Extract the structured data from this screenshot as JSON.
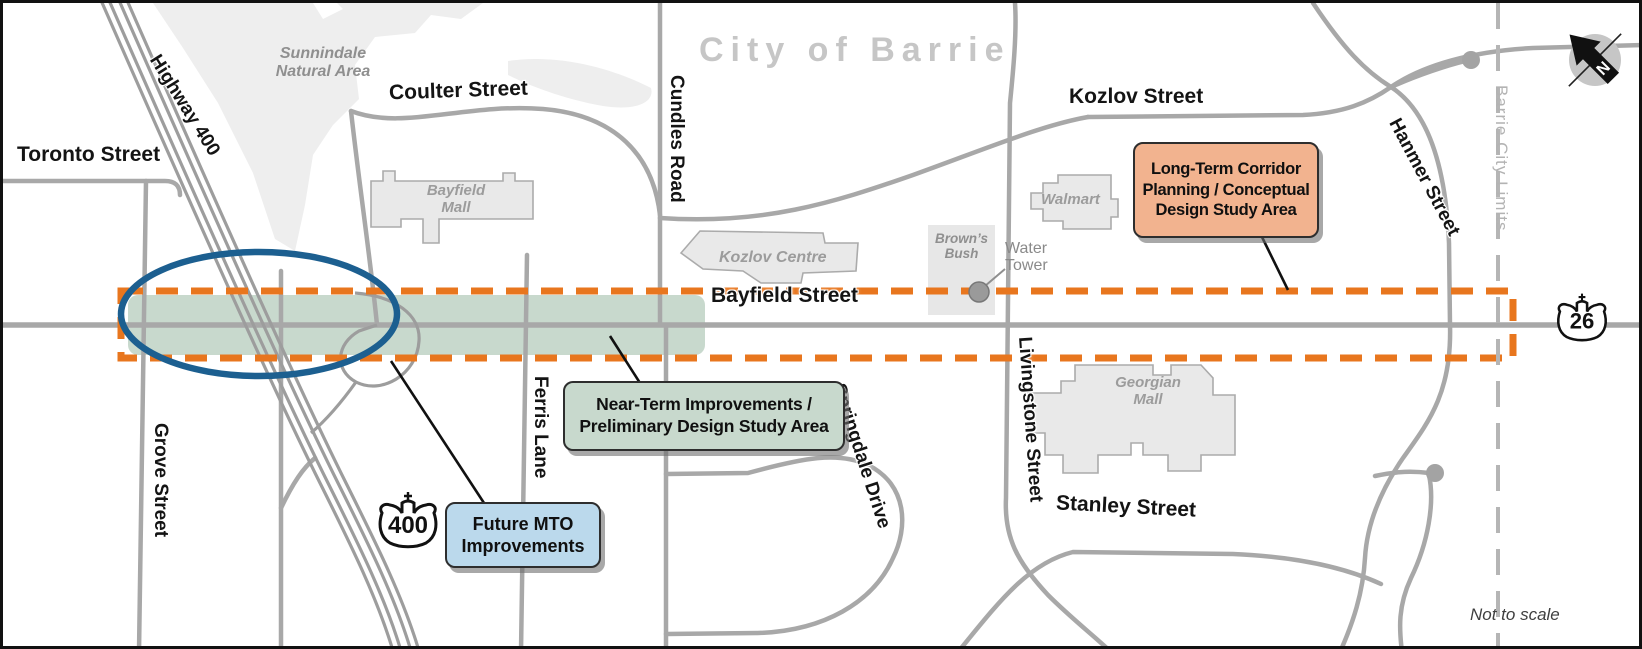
{
  "map_title": "City of Barrie",
  "scale_note": "Not to scale",
  "boundary_label": "Barrie City Limits",
  "compass": {
    "north_label": "N"
  },
  "streets": {
    "toronto": "Toronto Street",
    "coulter": "Coulter Street",
    "kozlov": "Kozlov Street",
    "bayfield": "Bayfield Street",
    "stanley": "Stanley Street",
    "grove": "Grove Street",
    "ferris": "Ferris Lane",
    "cundles": "Cundles Road",
    "livingstone": "Livingstone Street",
    "hanmer": "Hanmer Street",
    "springdale": "Springdale Drive",
    "highway400": "Highway 400"
  },
  "highway_shields": {
    "h400": "400",
    "h26": "26"
  },
  "places": {
    "sunnindale": {
      "lines": [
        "Sunnindale",
        "Natural Area"
      ]
    },
    "bayfield_mall": {
      "lines": [
        "Bayfield",
        "Mall"
      ]
    },
    "kozlov_centre": {
      "lines": [
        "Kozlov Centre"
      ]
    },
    "browns_bush": {
      "lines": [
        "Brown’s",
        "Bush"
      ]
    },
    "walmart": {
      "lines": [
        "Walmart"
      ]
    },
    "georgian_mall": {
      "lines": [
        "Georgian",
        "Mall"
      ]
    },
    "water_tower": {
      "lines": [
        "Water",
        "Tower"
      ]
    }
  },
  "callouts": {
    "long_term": {
      "lines": [
        "Long-Term Corridor",
        "Planning / Conceptual",
        "Design Study Area"
      ],
      "fill": "#F2B38F"
    },
    "near_term": {
      "lines": [
        "Near-Term Improvements /",
        "Preliminary Design Study Area"
      ],
      "fill": "#C8D9CD"
    },
    "future_mto": {
      "lines": [
        "Future MTO",
        "Improvements"
      ],
      "fill": "#BBD9EC"
    }
  },
  "colors": {
    "study_corridor_dash": "#E8761E",
    "near_term_area_fill": "#C8D9CD",
    "interchange_ellipse": "#1C5F90",
    "road_gray": "#A8A8A8",
    "building_fill": "#E9E9E9",
    "natural_area_fill": "#EEEEEE",
    "boundary_gray": "#B5B5B5"
  }
}
